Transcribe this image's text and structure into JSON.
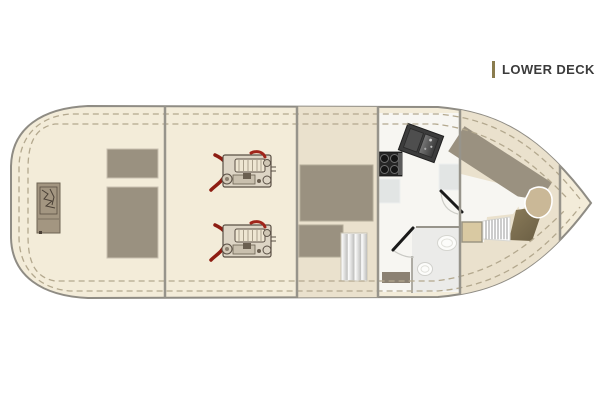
{
  "header": {
    "label": "LOWER DECK"
  },
  "colors": {
    "accent_bar": "#8a7c4e",
    "label_text": "#3b3b3b",
    "hull_fill": "#f3ecd9",
    "hull_outline": "#8f8c84",
    "deck_stitch": "#b3a88e",
    "floor_beige": "#eae1cd",
    "floor_white": "#f7f6f2",
    "head_floor": "#ebebe9",
    "wall": "#97948b",
    "furniture_gray": "#9a9180",
    "furniture_border": "#c9c1b1",
    "counter": "#e2e5e4",
    "stove_body": "#262626",
    "sink_body": "#3c3c3c",
    "engine_red": "#8e1d12",
    "engine_line": "#5a5045",
    "engine_fill": "#ddd5c5",
    "khaki_seat": "#cab897",
    "tan_table": "#d9c9a2",
    "olive_berth": "#7c6f52",
    "step_dark": "#8b8173",
    "equipment_box": "#a39681",
    "stair_edge": "#c8c2b2",
    "fixture_white": "#fcfcfa"
  },
  "plan": {
    "type": "boat-floor-plan",
    "deck": "lower",
    "rooms": [
      {
        "name": "lazarette-stern-compartment"
      },
      {
        "name": "engine-room"
      },
      {
        "name": "mid-cabin"
      },
      {
        "name": "galley"
      },
      {
        "name": "head-bathroom"
      },
      {
        "name": "forward-cabin"
      }
    ],
    "fixtures": [
      "generator-unit",
      "stern-locker-small",
      "stern-locker-large",
      "engine-port",
      "engine-starboard",
      "berth-main",
      "berth-foot",
      "companionway-stairs",
      "stove-4-burner",
      "double-sink",
      "counter",
      "counter-2",
      "head-door",
      "head-sink",
      "toilet",
      "vanity-step",
      "forward-cabin-door",
      "v-berth-diagonal",
      "helm-seat",
      "forward-ladder",
      "table-hatch",
      "olive-berth-section"
    ]
  }
}
